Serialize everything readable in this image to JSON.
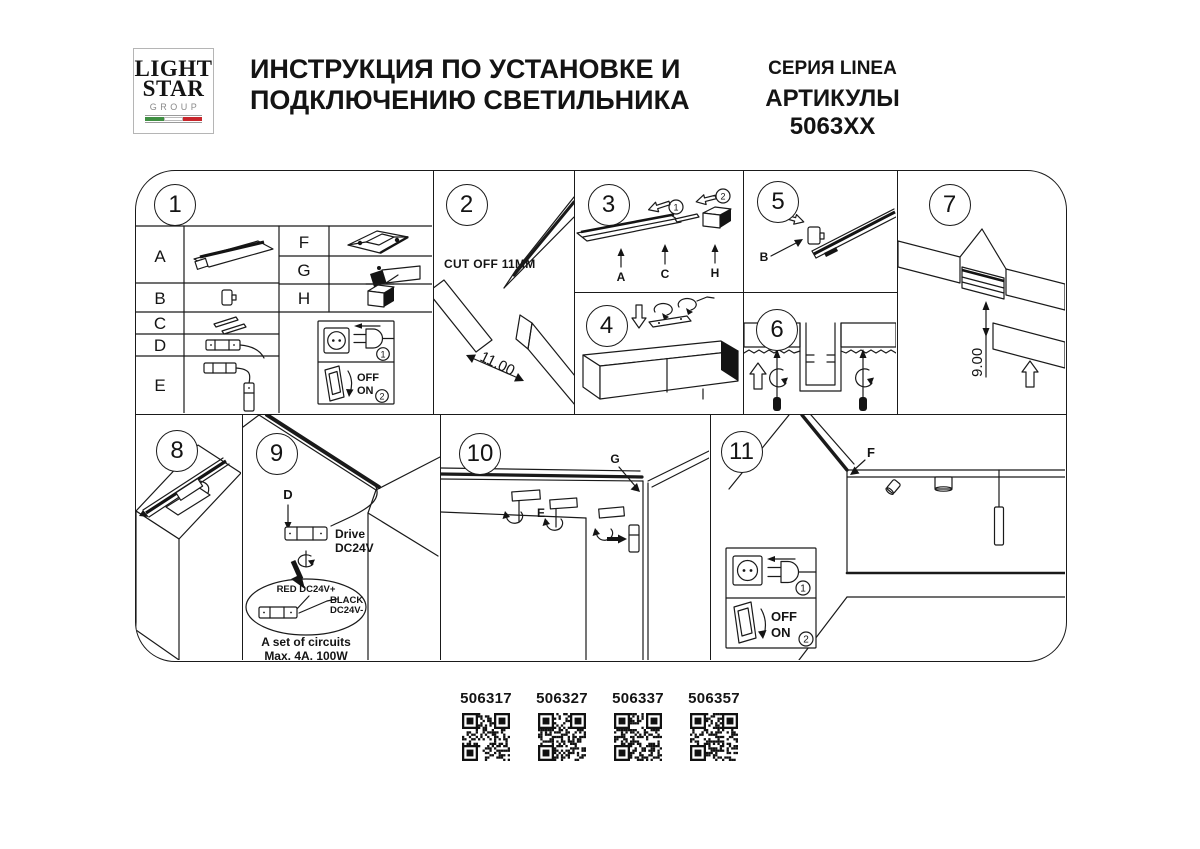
{
  "header": {
    "logo": {
      "line1": "LIGHT",
      "line2": "STAR",
      "line3": "GROUP"
    },
    "title_line1": "ИНСТРУКЦИЯ ПО УСТАНОВКЕ И",
    "title_line2": "ПОДКЛЮЧЕНИЮ СВЕТИЛЬНИКА",
    "series": "СЕРИЯ LINEA",
    "articles": "АРТИКУЛЫ 5063XX"
  },
  "panels": {
    "p1": {
      "number": "1",
      "letters": {
        "a": "A",
        "b": "B",
        "c": "C",
        "d": "D",
        "e": "E",
        "f": "F",
        "g": "G",
        "h": "H"
      }
    },
    "p2": {
      "number": "2",
      "cut_off": "CUT OFF 11MM",
      "dimension": "11.00"
    },
    "p3": {
      "number": "3",
      "step1": "1",
      "step2": "2",
      "label_a": "A",
      "label_c": "C",
      "label_h": "H"
    },
    "p4": {
      "number": "4"
    },
    "p5": {
      "number": "5",
      "step1": "1",
      "label_b": "B"
    },
    "p6": {
      "number": "6"
    },
    "p7": {
      "number": "7",
      "dimension": "9.00"
    },
    "p8": {
      "number": "8"
    },
    "p9": {
      "number": "9",
      "label_d": "D",
      "drive_line1": "Drive",
      "drive_line2": "DC24V",
      "wire_red": "RED DC24V+",
      "wire_black_line1": "BLACK",
      "wire_black_line2": "DC24V-",
      "circuits_line1": "A set of circuits",
      "circuits_line2": "Max. 4A, 100W"
    },
    "p10": {
      "number": "10",
      "label_e": "E",
      "label_g": "G"
    },
    "p11": {
      "number": "11",
      "label_f": "F"
    }
  },
  "power": {
    "plug_step": "1",
    "switch_step": "2",
    "off": "OFF",
    "on": "ON"
  },
  "colors": {
    "ink": "#1a1a1a",
    "flag_green": "#3f8f42",
    "flag_red": "#c8262c"
  },
  "qr": {
    "items": [
      {
        "code": "506317"
      },
      {
        "code": "506327"
      },
      {
        "code": "506337"
      },
      {
        "code": "506357"
      }
    ]
  }
}
